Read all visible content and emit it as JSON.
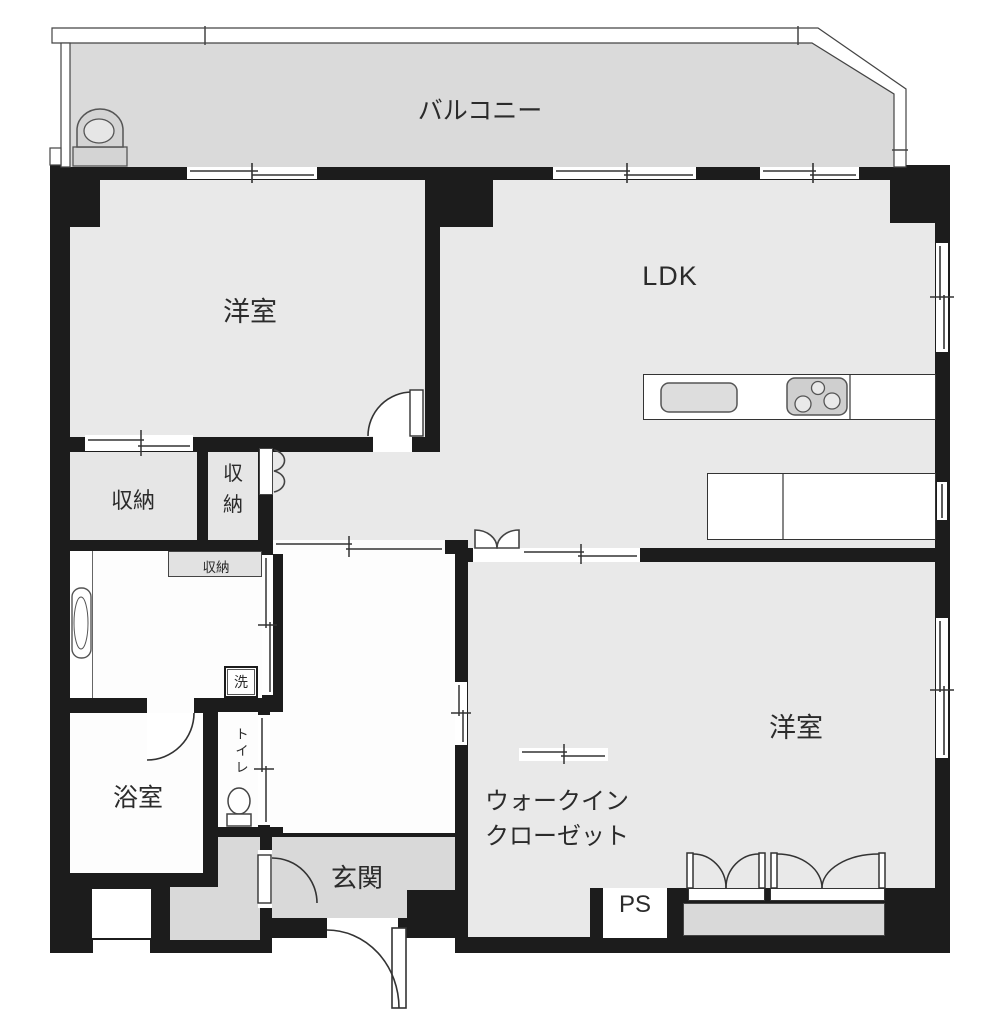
{
  "plan_title": "マンション間取り図",
  "labels": {
    "balcony": "バルコニー",
    "bedroom_upper": "洋室",
    "ldk": "LDK",
    "bedroom_lower": "洋室",
    "storage_1": "収納",
    "storage_2": "収納",
    "storage_shelf": "収納",
    "washer": "洗",
    "toilet": "トイレ",
    "bath": "浴室",
    "entrance": "玄関",
    "wic_line1": "ウォークイン",
    "wic_line2": "クローゼット",
    "pipe_space": "PS"
  },
  "icons": [
    "slop-sink-icon",
    "washbasin-icon",
    "toilet-icon",
    "kitchen-sink-icon",
    "stove-icon",
    "door-arc-icon",
    "double-door-icon",
    "bifold-door-icon",
    "closet-doors-icon",
    "sliding-window-icon"
  ],
  "colors": {
    "wall": "#1c1c1c",
    "room_floor": "#e9e9e9",
    "service_floor": "#d9d9d9",
    "storage_floor": "#e6e6e6",
    "wet_floor": "#fdfdfd",
    "stroke": "#444444",
    "text": "#2b2b2b"
  }
}
